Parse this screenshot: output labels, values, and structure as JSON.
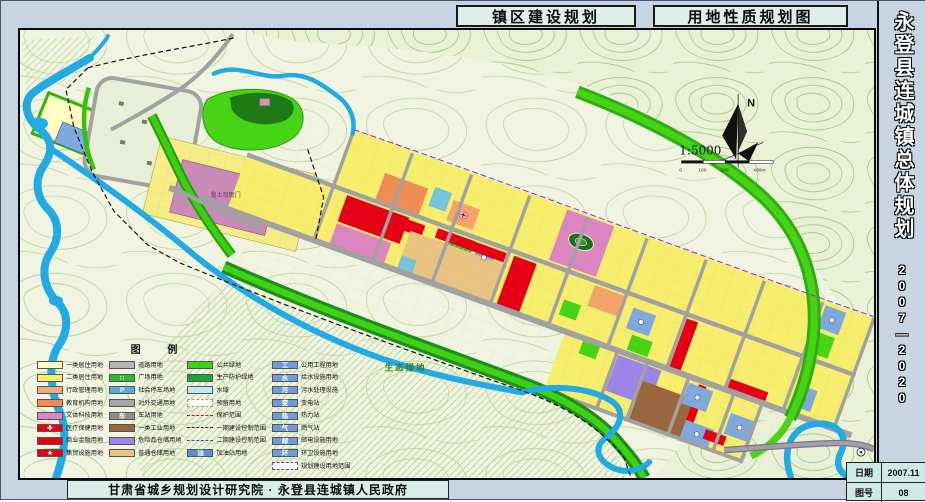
{
  "header": {
    "box1": "镇区建设规划",
    "box2": "用地性质规划图"
  },
  "sidebar": {
    "title": "永登县连城镇总体规划",
    "period": "2007—2020",
    "date_label": "日期",
    "date_value": "2007.11",
    "sheet_label": "图号",
    "sheet_value": "08"
  },
  "footer": {
    "credit": "甘肃省城乡规划设计研究院 · 永登县连城镇人民政府"
  },
  "map": {
    "north_label": "N",
    "scale_text": "1:5000",
    "scale_ticks": {
      "t0": "0",
      "t1": "100",
      "t2": "200",
      "t3": "400m"
    },
    "eco_label": "生态绿地",
    "site_label": "鲁土司衙门",
    "colors": {
      "water": "#22aae4",
      "residential": "#f7ee6e",
      "commercial": "#e60016",
      "public_green": "#3ed312",
      "road": "#a1a1a1",
      "industry": "#99663d",
      "warehouse": "#eac383",
      "culture": "#dd85c0",
      "utility": "#6f9bdc"
    },
    "legend": {
      "title": "图  例",
      "columns": [
        [
          {
            "label": "一类居住用地",
            "c": "#ffffc2"
          },
          {
            "label": "二类居住用地",
            "c": "#f7ee6e"
          },
          {
            "label": "行政管理用地",
            "c": "#f3a97e"
          },
          {
            "label": "教育机构用地",
            "c": "#ef8d55"
          },
          {
            "label": "文体科技用地",
            "c": "#dd85c0"
          },
          {
            "label": "医疗保健用地",
            "c": "#e60016",
            "g": "✚"
          },
          {
            "label": "商业金融用地",
            "c": "#e60016"
          },
          {
            "label": "集贸设施用地",
            "c": "#e60016",
            "g": "★"
          }
        ],
        [
          {
            "label": "道路用地",
            "c": "#b3b3b3"
          },
          {
            "label": "广场用地",
            "c": "#2db92d",
            "g": "∷"
          },
          {
            "label": "社会停车场地",
            "c": "#56aede",
            "g": "P"
          },
          {
            "label": "对外交通用地",
            "c": "#a6a6a6"
          },
          {
            "label": "车站用地",
            "c": "#8f8f8f",
            "g": "车"
          },
          {
            "label": "一类工业用地",
            "c": "#99663d"
          },
          {
            "label": "危险品仓储用地",
            "c": "#9b85e6"
          },
          {
            "label": "普通仓储用地",
            "c": "#eac383"
          }
        ],
        [
          {
            "label": "公共绿地",
            "c": "#3ed312"
          },
          {
            "label": "生产防护绿地",
            "c": "#1fa33c"
          },
          {
            "label": "水域",
            "c": "#bfeaf2"
          },
          {
            "label": "预留用地",
            "t": "dashbox",
            "bc": "#999999"
          },
          {
            "label": "保护范围",
            "t": "line",
            "lc": "#e60016"
          },
          {
            "label": "一期建设控制范围",
            "t": "line",
            "lc": "#222222"
          },
          {
            "label": "二期建设控制范围",
            "t": "line",
            "lc": "#2255cc"
          },
          {
            "label": "加油站用地",
            "c": "#5a8fd8",
            "g": "油"
          }
        ],
        [
          {
            "label": "公用工程用地",
            "c": "#6f9bdc",
            "g": "工"
          },
          {
            "label": "给水设施用地",
            "c": "#6f9bdc",
            "g": "水"
          },
          {
            "label": "污水处理设施",
            "c": "#6f9bdc",
            "g": "污"
          },
          {
            "label": "变电站",
            "c": "#6f9bdc",
            "g": "变"
          },
          {
            "label": "热力站",
            "c": "#6f9bdc",
            "g": "热"
          },
          {
            "label": "燃气站",
            "c": "#6f9bdc",
            "g": "气"
          },
          {
            "label": "邮电设施用地",
            "c": "#6f9bdc",
            "g": "邮"
          },
          {
            "label": "环卫设施用地",
            "c": "#6f9bdc",
            "g": "环"
          },
          {
            "label": "规划建设用地范围",
            "t": "dashbox",
            "bc": "#8b2fc9"
          }
        ]
      ]
    }
  }
}
